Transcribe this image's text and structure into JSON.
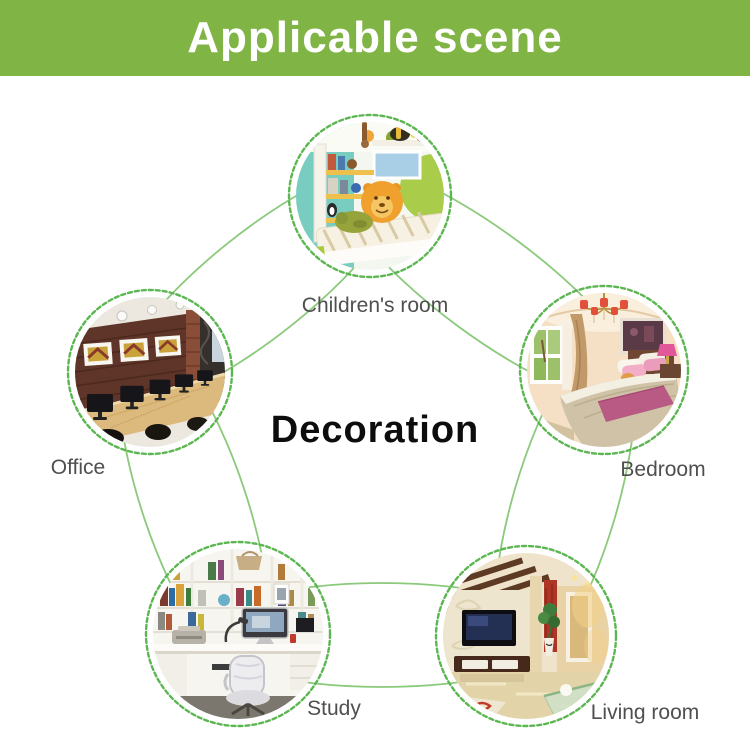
{
  "banner": {
    "title": "Applicable scene"
  },
  "center_label": "Decoration",
  "scenes": [
    {
      "id": "children-room",
      "label": "Children's room"
    },
    {
      "id": "bedroom",
      "label": "Bedroom"
    },
    {
      "id": "living-room",
      "label": "Living room"
    },
    {
      "id": "study",
      "label": "Study"
    },
    {
      "id": "office",
      "label": "Office"
    }
  ],
  "colors": {
    "banner_bg": "#80b445",
    "banner_text": "#ffffff",
    "link_line": "#8bc97b",
    "ring_dash": "#5cb651",
    "label_text": "#4f4f4f",
    "center_text": "#0d0d0d"
  }
}
